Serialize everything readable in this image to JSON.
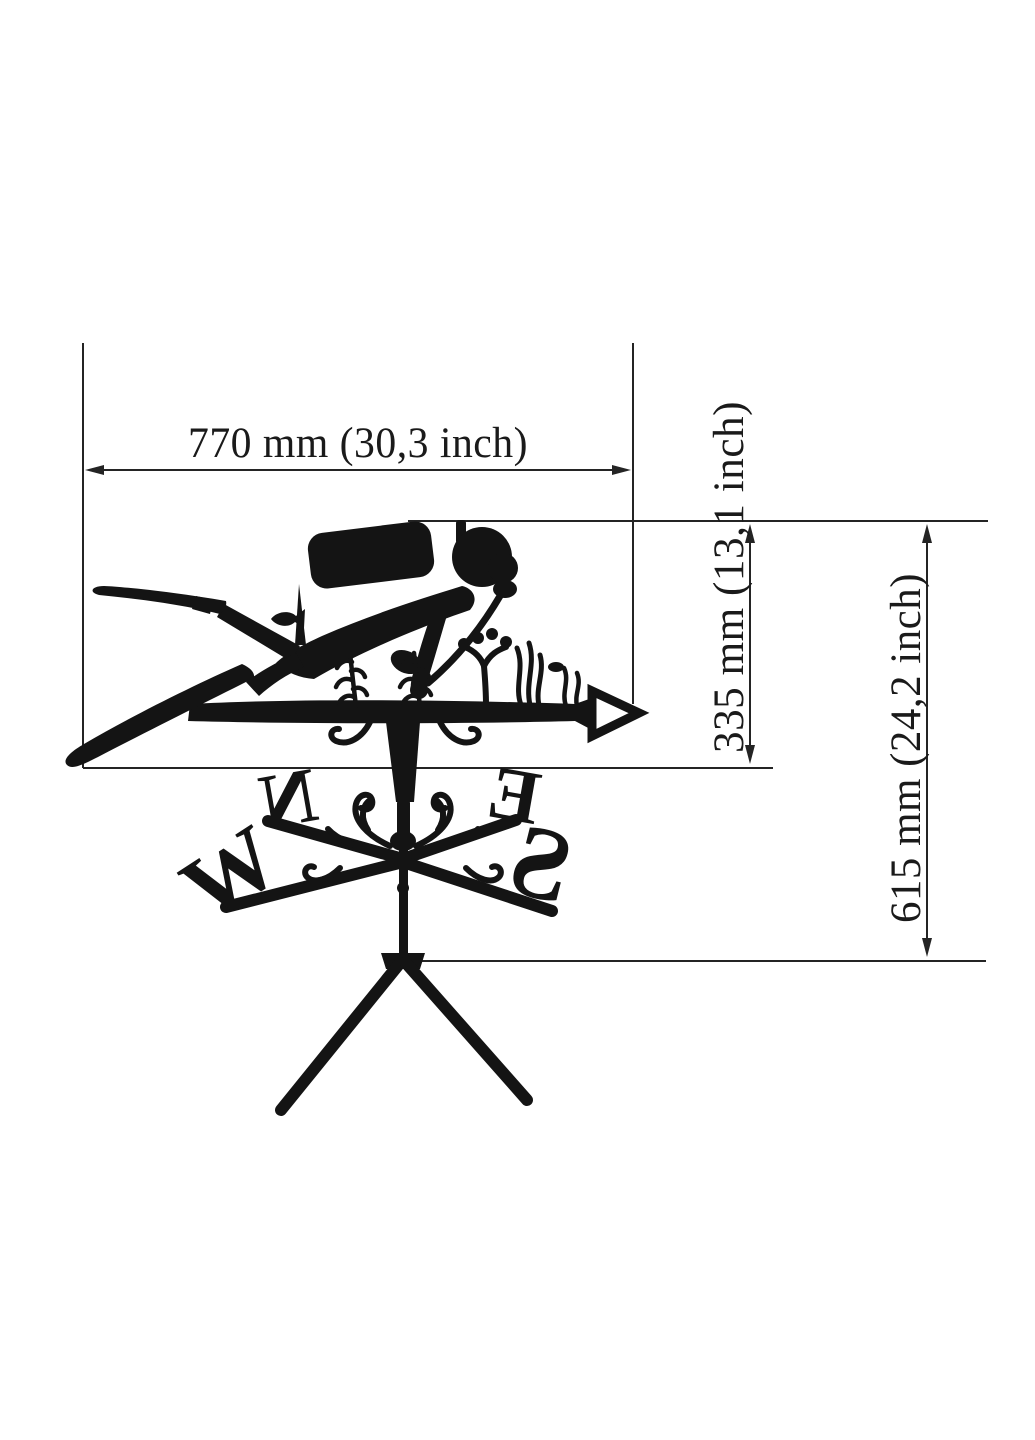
{
  "page": {
    "background": "#ffffff"
  },
  "diagram": {
    "subject": "scuba diver weathervane dimension drawing",
    "ink_color": "#141414",
    "dimension_line_color": "#242424",
    "labels": {
      "width": "770 mm (30,3 inch)",
      "vane_height": "335 mm (13,1 inch)",
      "total_height": "615 mm (24,2 inch)"
    },
    "compass": {
      "north": "N",
      "east": "E",
      "south": "S",
      "west": "W"
    }
  }
}
